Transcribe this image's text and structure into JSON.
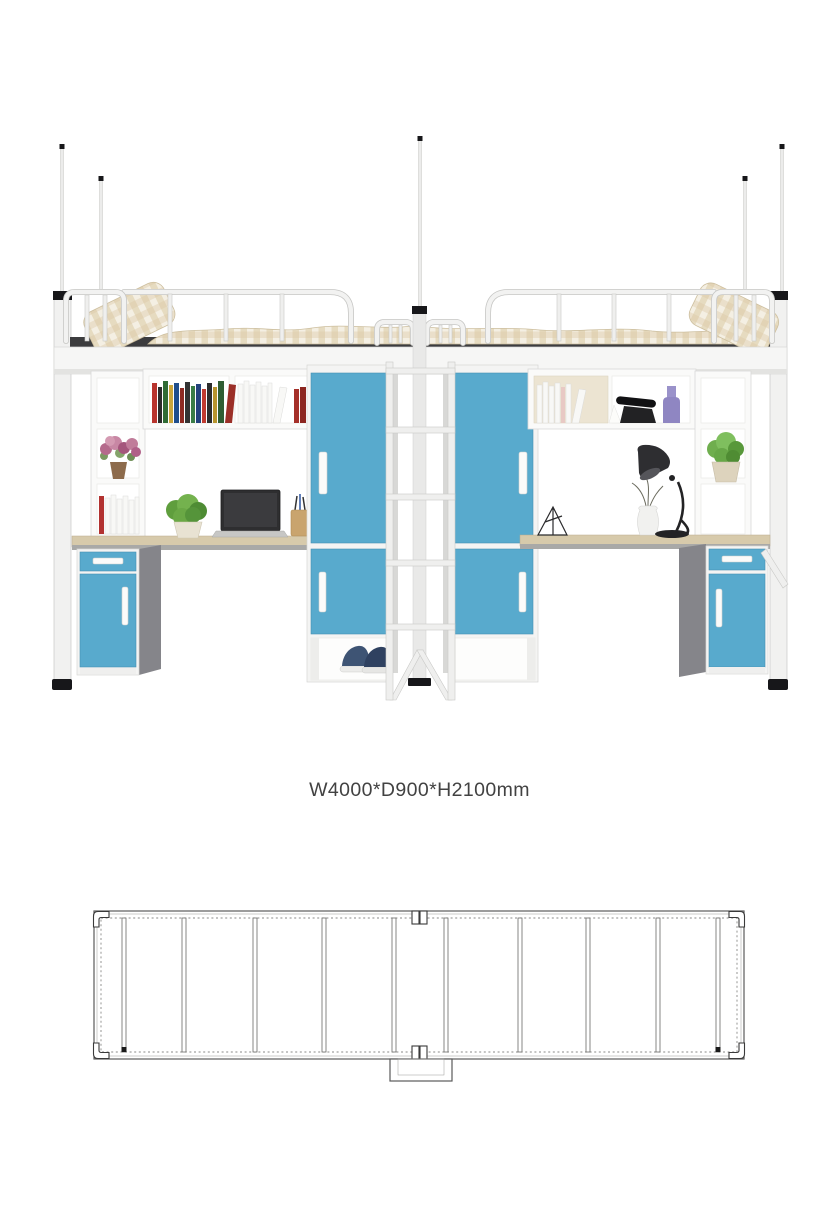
{
  "product": {
    "dimensions_label": "W4000*D900*H2100mm",
    "dimensions": {
      "width_mm": 4000,
      "depth_mm": 900,
      "height_mm": 2100
    }
  },
  "colors": {
    "cabinet_blue": "#58aacd",
    "desk_wood": "#d7caab",
    "bedding_beige": "#dbc9a4",
    "accent_black": "#17171a",
    "label_text": "#424242",
    "drawing_line": "#5a5a5a"
  }
}
